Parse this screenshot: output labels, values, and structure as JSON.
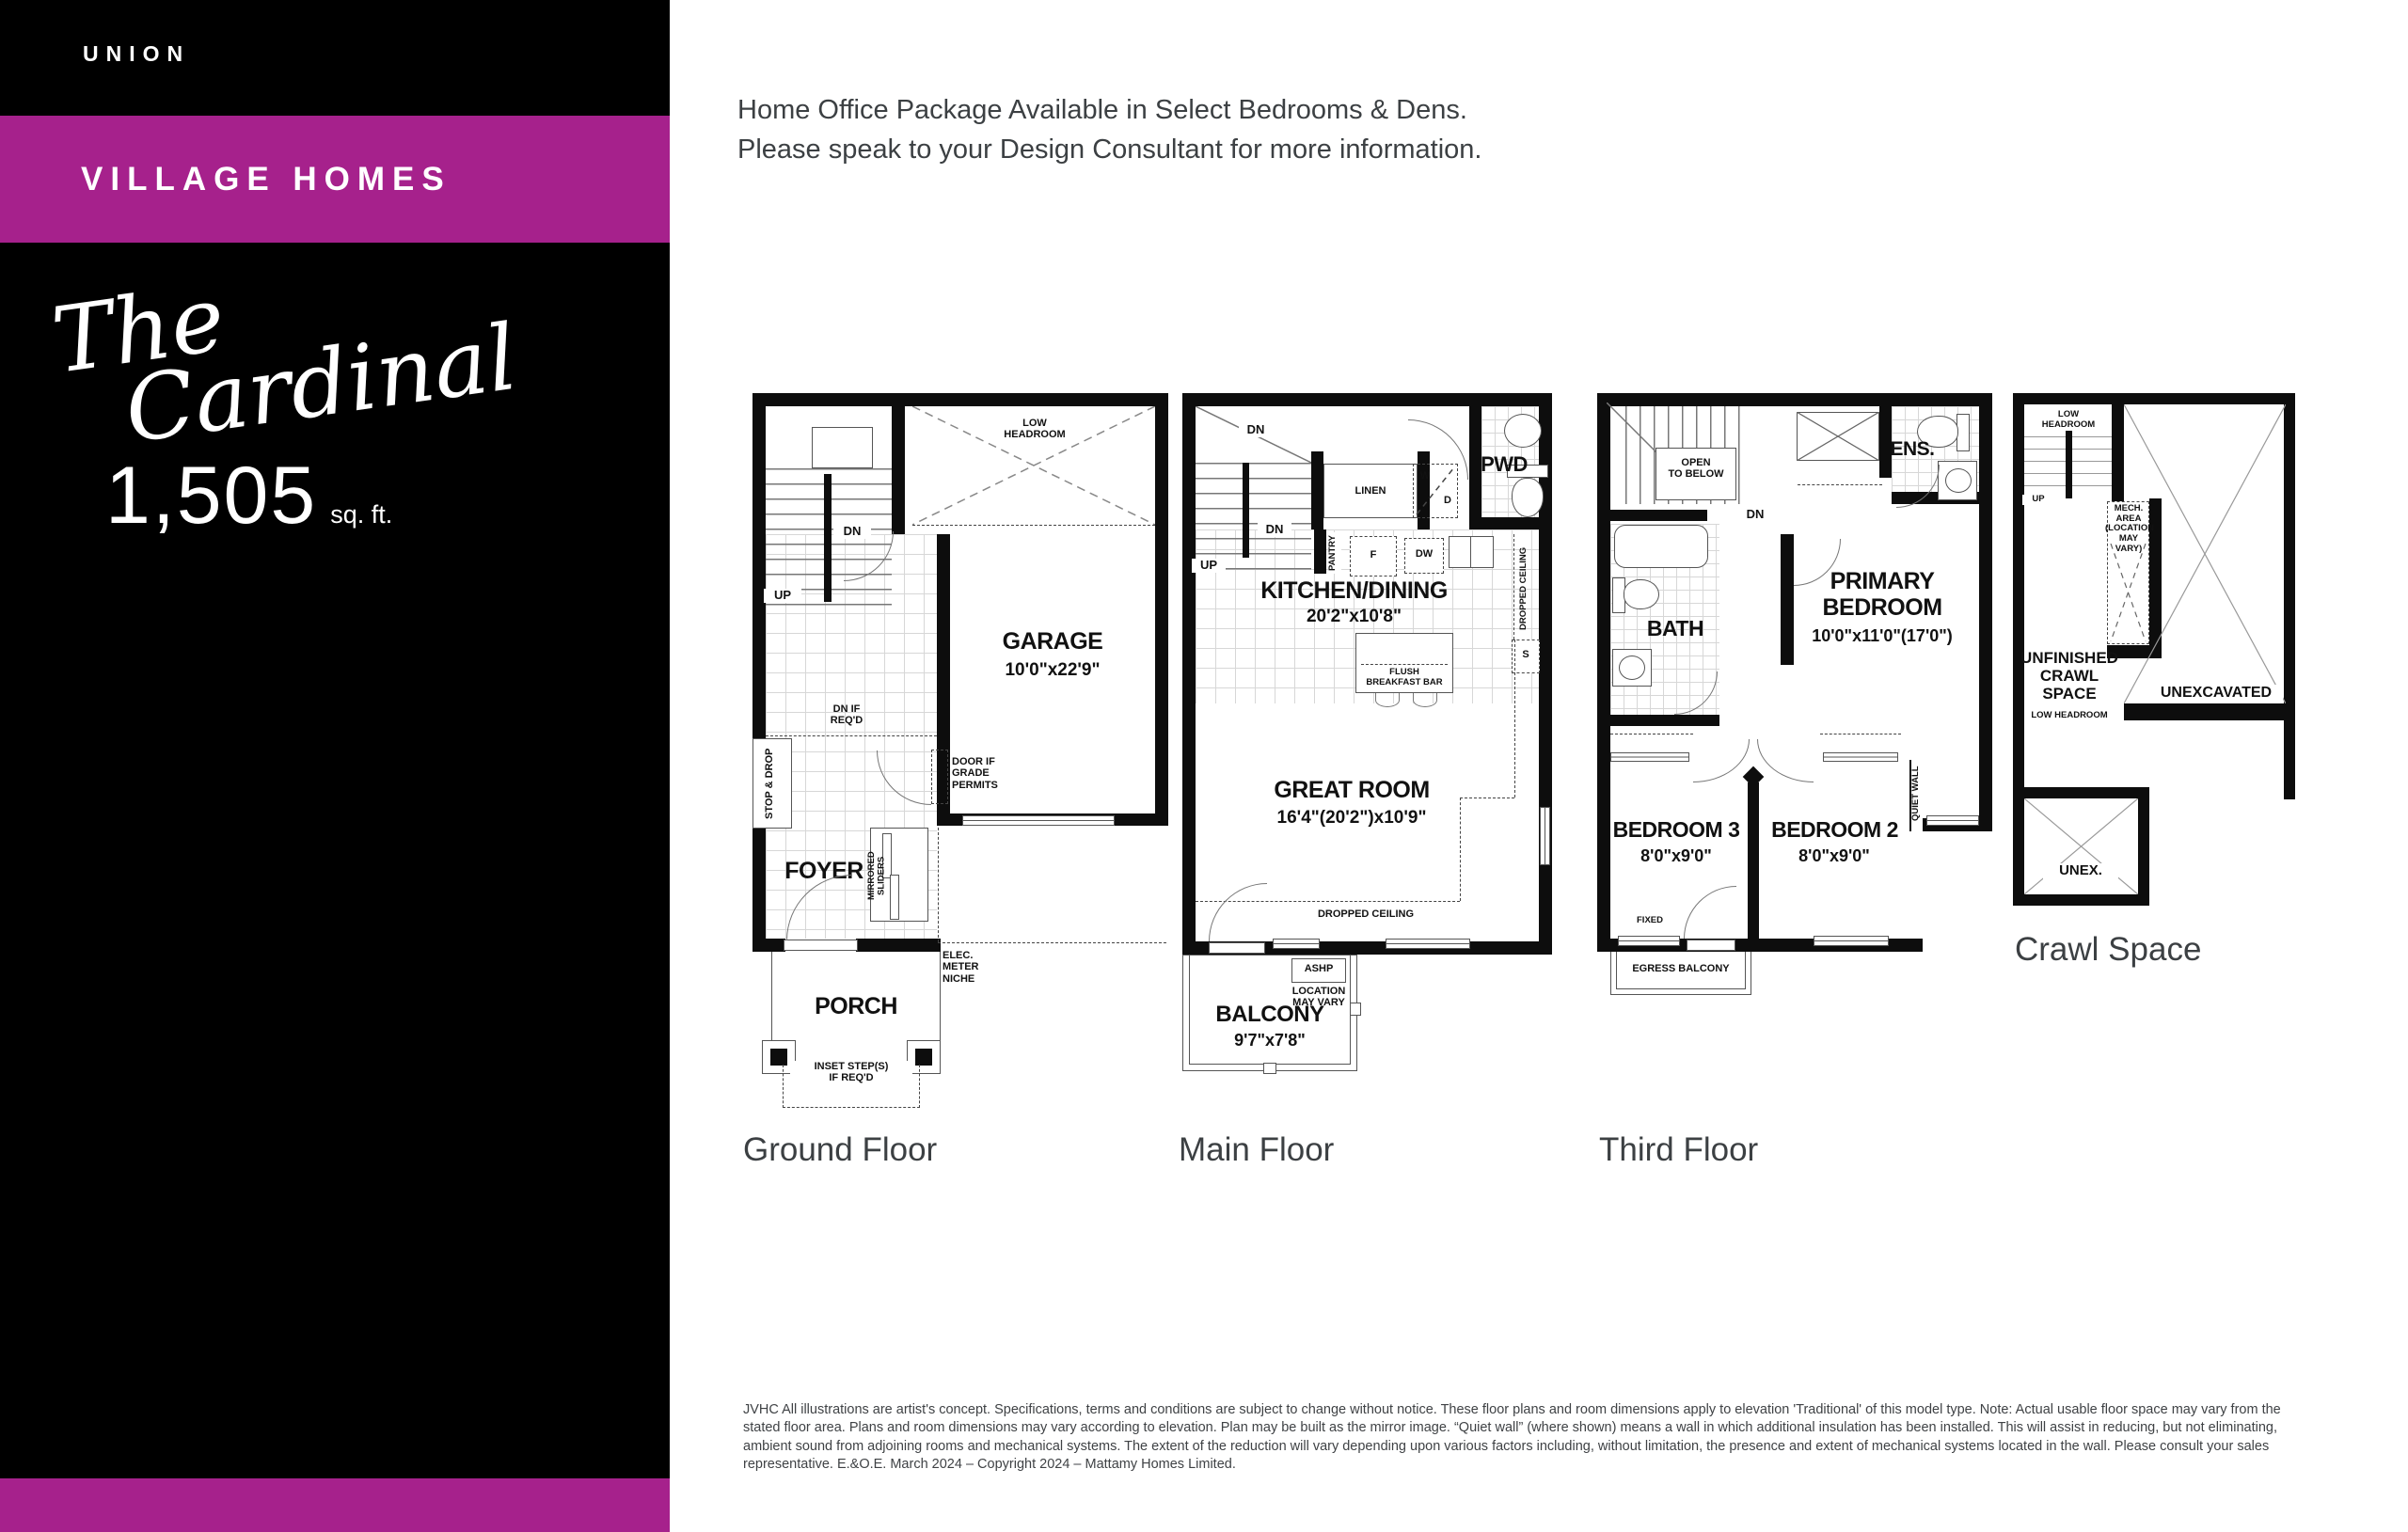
{
  "colors": {
    "accent_magenta": "#A6218C",
    "sidebar_black": "#000000",
    "wall_black": "#0d0d0d",
    "caption_gray": "#3c4043"
  },
  "sidebar": {
    "brand": "UNION",
    "collection": "VILLAGE HOMES",
    "model_script": {
      "line1": "The",
      "line2": "Cardinal"
    },
    "area_value": "1,505",
    "area_unit": "sq. ft."
  },
  "header": {
    "line1": "Home Office Package Available in Select Bedrooms & Dens.",
    "line2": "Please speak to your Design Consultant for more information."
  },
  "plans": {
    "ground": {
      "caption": "Ground Floor",
      "labels": {
        "low_headroom": "LOW\nHEADROOM",
        "garage_name": "GARAGE",
        "garage_dim": "10'0\"x22'9\"",
        "dn": "DN",
        "up": "UP",
        "dn_if_reqd": "DN IF\nREQ'D",
        "stop_drop": "STOP & DROP",
        "door_grade": "DOOR IF\nGRADE\nPERMITS",
        "foyer": "FOYER",
        "mirrored_sliders": "MIRRORED SLIDERS",
        "elec_meter": "ELEC.\nMETER\nNICHE",
        "porch": "PORCH",
        "inset_steps": "INSET STEP(S)\nIF REQ'D"
      }
    },
    "main": {
      "caption": "Main Floor",
      "labels": {
        "dn": "DN",
        "up": "UP",
        "linen": "LINEN",
        "w": "W",
        "d": "D",
        "pwd": "PWD",
        "pantry": "PANTRY",
        "f": "F",
        "dw": "DW",
        "s": "S",
        "dropped_ceiling_side": "DROPPED CEILING",
        "kitchen_name": "KITCHEN/DINING",
        "kitchen_dim": "20'2\"x10'8\"",
        "flush_bar": "FLUSH\nBREAKFAST BAR",
        "great_name": "GREAT ROOM",
        "great_dim": "16'4\"(20'2\")x10'9\"",
        "dropped_ceiling_bottom": "DROPPED CEILING",
        "ashp": "ASHP",
        "ashp_note": "LOCATION\nMAY VARY",
        "balcony_name": "BALCONY",
        "balcony_dim": "9'7\"x7'8\""
      }
    },
    "third": {
      "caption": "Third Floor",
      "labels": {
        "open_below": "OPEN\nTO BELOW",
        "dn": "DN",
        "ens": "ENS.",
        "bath": "BATH",
        "primary_name": "PRIMARY\nBEDROOM",
        "primary_dim": "10'0\"x11'0\"(17'0\")",
        "bedroom3_name": "BEDROOM 3",
        "bedroom3_dim": "8'0\"x9'0\"",
        "bedroom2_name": "BEDROOM 2",
        "bedroom2_dim": "8'0\"x9'0\"",
        "quiet_wall": "QUIET WALL",
        "fixed": "FIXED",
        "egress": "EGRESS BALCONY"
      }
    },
    "crawl": {
      "caption": "Crawl Space",
      "labels": {
        "low_headroom": "LOW\nHEADROOM",
        "up": "UP",
        "mech": "MECH. AREA\n(LOCATION\nMAY VARY)",
        "unfinished": "UNFINISHED\nCRAWL\nSPACE",
        "unfinished_sub": "LOW HEADROOM",
        "unexcavated": "UNEXCAVATED",
        "unex": "UNEX."
      }
    }
  },
  "footer": {
    "disclaimer": "JVHC All illustrations are artist's concept. Specifications, terms and conditions are subject to change without notice. These floor plans and room dimensions apply to elevation 'Traditional' of this model type. Note: Actual usable floor space may vary from the stated floor area. Plans and room dimensions may vary according to elevation. Plan may be built as the mirror image. “Quiet wall” (where shown) means a wall in which additional insulation has been installed. This will assist in reducing, but not eliminating, ambient sound from adjoining rooms and mechanical systems. The extent of the reduction will vary depending upon various factors including, without limitation, the presence and extent of mechanical systems located in the wall. Please consult your sales representative. E.&O.E. March 2024 – Copyright 2024 – Mattamy Homes Limited."
  }
}
